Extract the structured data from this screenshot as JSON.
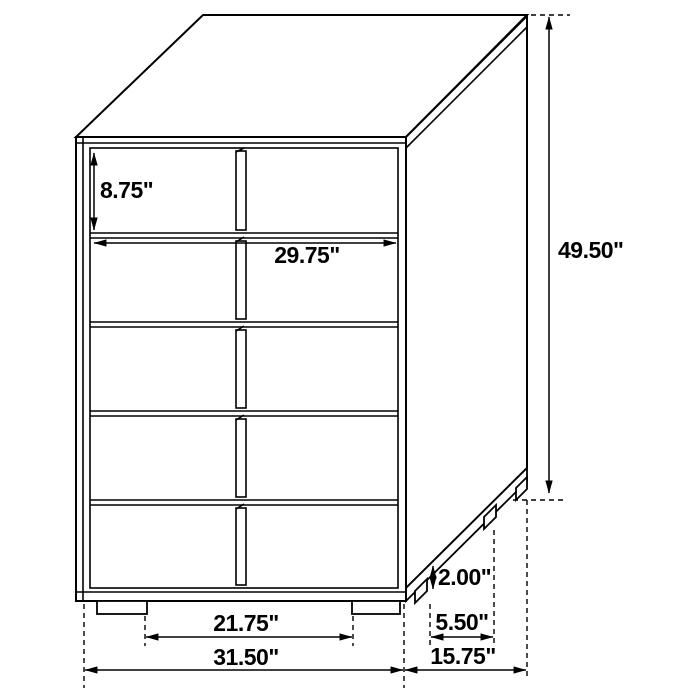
{
  "figure": {
    "name": "chest-dimension-diagram",
    "style": "black line drawing, oblique 3D view, five-drawer chest with split drawer fronts, center vertical pulls, four legs"
  },
  "colors": {
    "line": "#000000",
    "background": "#ffffff",
    "label_text": "#000000"
  },
  "dimensions": {
    "drawer_height": {
      "label": "8.75\"",
      "value": 8.75,
      "unit": "in",
      "orientation": "vertical",
      "measures": "top drawer face height"
    },
    "drawer_width": {
      "label": "29.75\"",
      "value": 29.75,
      "unit": "in",
      "orientation": "horizontal",
      "measures": "drawer front width"
    },
    "overall_height": {
      "label": "49.50\"",
      "value": 49.5,
      "unit": "in",
      "orientation": "vertical",
      "measures": "overall height"
    },
    "leg_height": {
      "label": "2.00\"",
      "value": 2.0,
      "unit": "in",
      "orientation": "vertical",
      "measures": "leg height"
    },
    "side_leg_spacing": {
      "label": "5.50\"",
      "value": 5.5,
      "unit": "in",
      "orientation": "horizontal",
      "measures": "side leg spacing"
    },
    "front_leg_spacing": {
      "label": "21.75\"",
      "value": 21.75,
      "unit": "in",
      "orientation": "horizontal",
      "measures": "front leg spacing"
    },
    "overall_width": {
      "label": "31.50\"",
      "value": 31.5,
      "unit": "in",
      "orientation": "horizontal",
      "measures": "overall width"
    },
    "overall_depth": {
      "label": "15.75\"",
      "value": 15.75,
      "unit": "in",
      "orientation": "horizontal",
      "measures": "overall depth"
    }
  }
}
